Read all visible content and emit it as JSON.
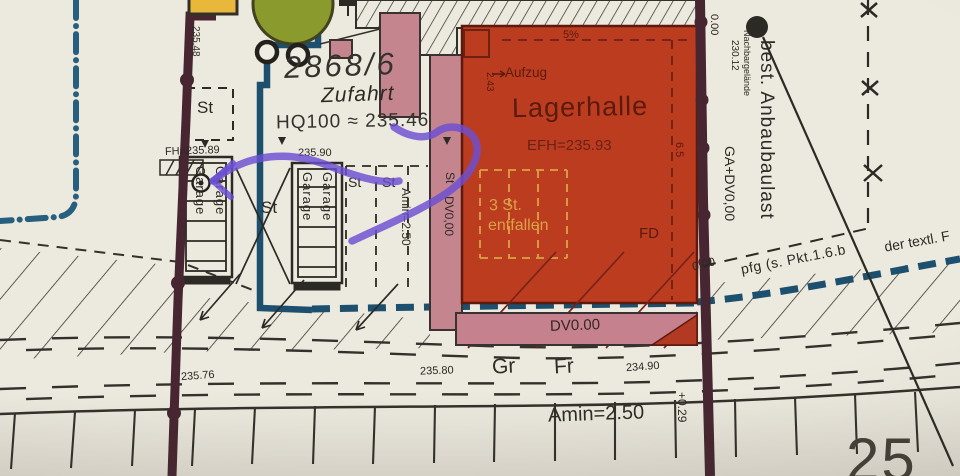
{
  "parcel": {
    "number": "2868/6",
    "access_label": "Zufahrt",
    "flood_level": "HQ100 ≈ 235.46"
  },
  "building": {
    "name": "Lagerhalle",
    "floor_level": "EFH=235.93",
    "elevator": "Aufzug",
    "elevator_dim": "2.43",
    "slope": "5%",
    "inner_dim": "6.5",
    "omitted_line1": "3 St.",
    "omitted_line2": "entfallen",
    "roof": "FD"
  },
  "parking": {
    "garage": "Garage",
    "stall": "St",
    "fh_level": "FH=235.89",
    "level_235_90": "235.90",
    "level_left_edge": "235.48",
    "aisle_dim": "Amin=2.50",
    "canopy": "DV0,00"
  },
  "street": {
    "canopy_level": "DV0.00",
    "gr": "Gr",
    "fr": "Fr",
    "level_235_76": "235.76",
    "level_235_80": "235.80",
    "level_234_90": "234.90",
    "aisle_dim": "Amin=2.50",
    "offset": "+0.29",
    "partial_number": "25"
  },
  "neighbor": {
    "zero_top": "0.00",
    "zero_corner": "0.00",
    "site_label": "Nachbargelände",
    "site_level": "230.12",
    "baulast": "best. Anbaubaulast",
    "ga_dv": "GA+DV0,00",
    "note_pfg": "pfg (s. Pkt.1.6.b",
    "note_textl": "der textl. F"
  },
  "colors": {
    "building_new": "#bc3c20",
    "building_existing": "#c4858f",
    "boundary": "#472631",
    "water_line": "#1d4f6e",
    "flood_line": "#27607f",
    "marker_purple": "#6b4ed2",
    "highlight_yellow": "#e9b83b",
    "tree_green": "#8a9a2c",
    "omitted_text": "#d9a245"
  }
}
